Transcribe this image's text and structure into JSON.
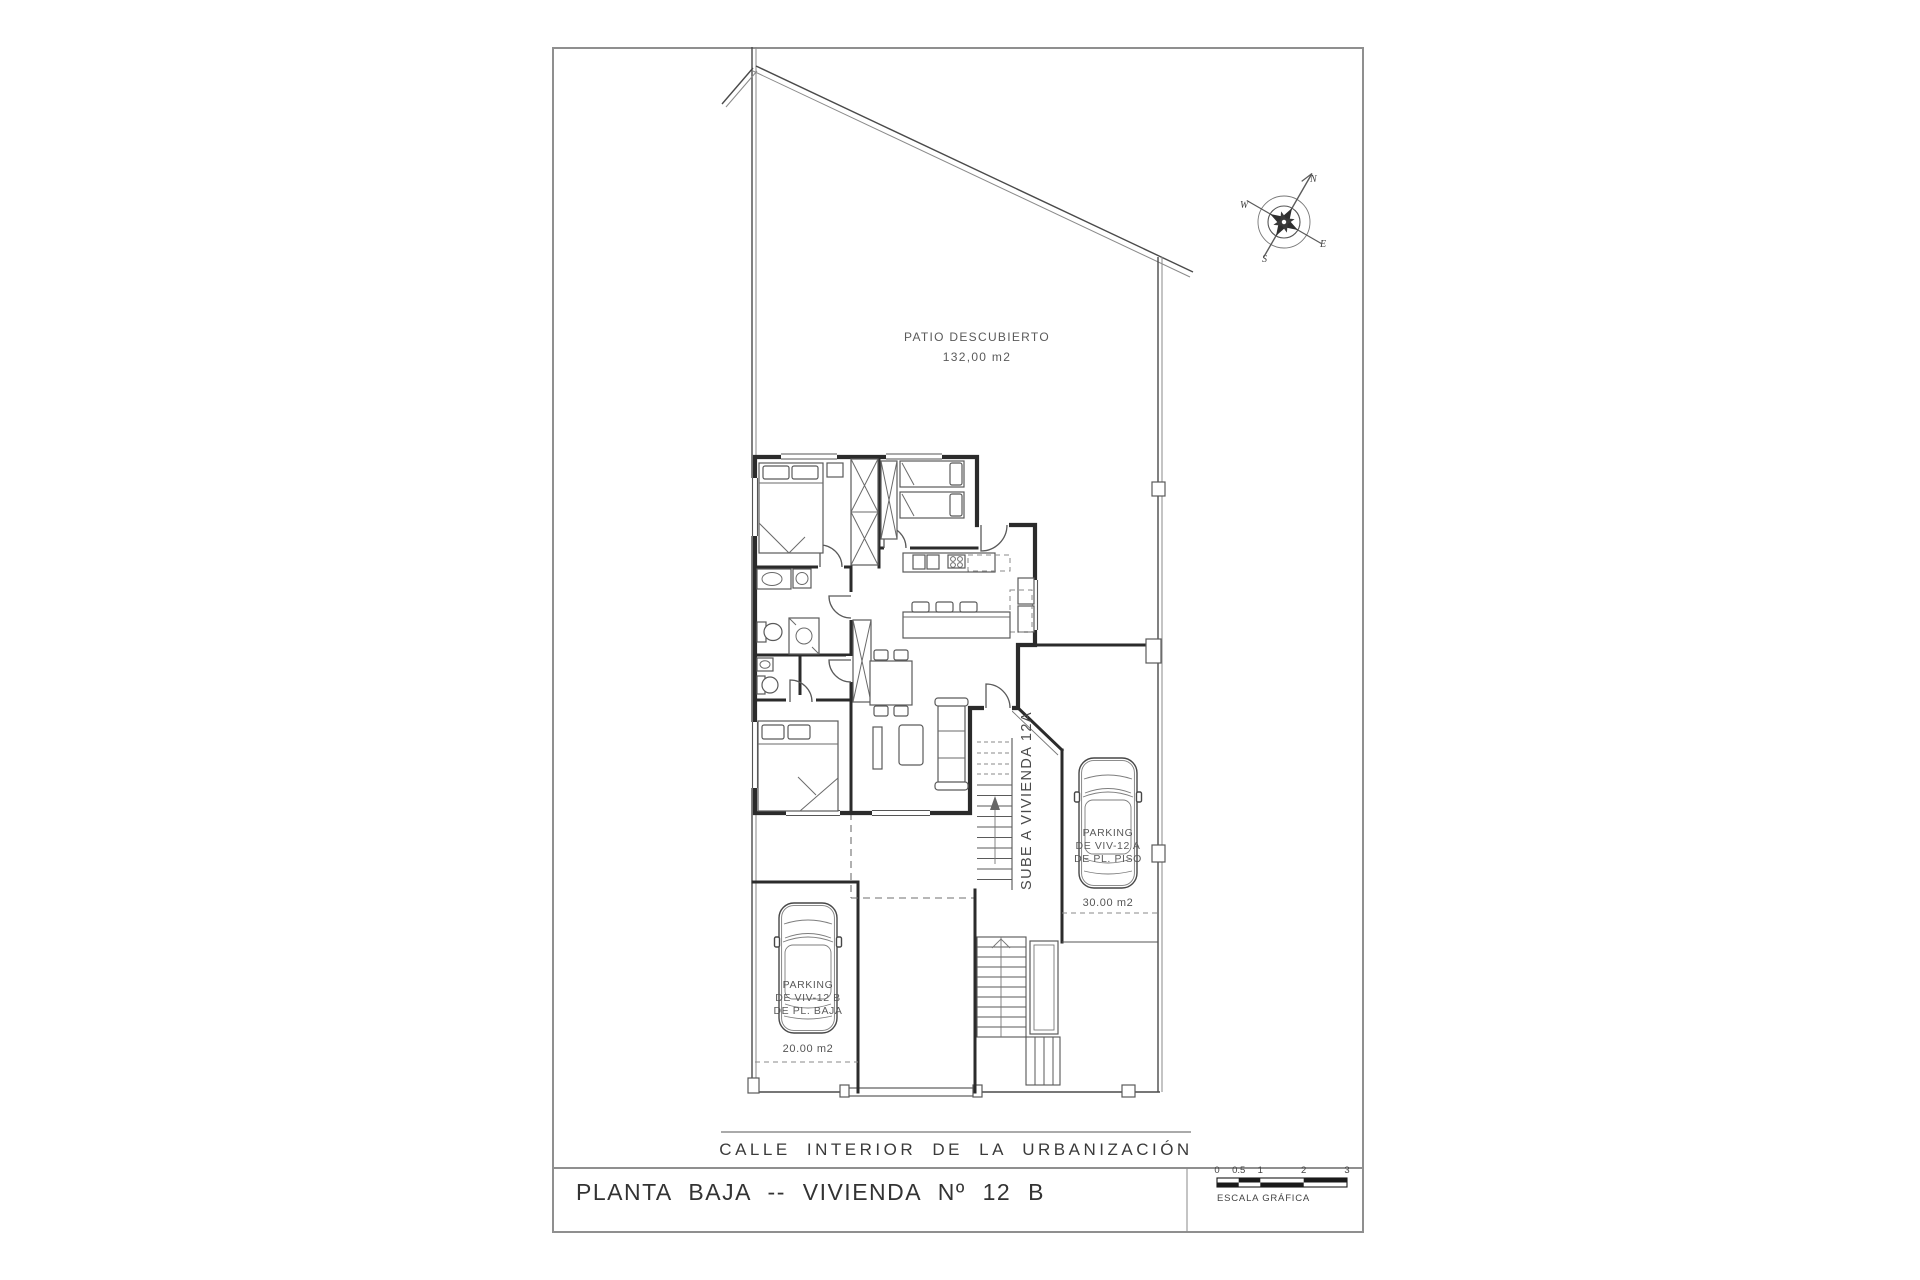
{
  "drawing": {
    "title_block": {
      "title": "PLANTA BAJA -- VIVIENDA Nº 12 B"
    },
    "street": {
      "label": "CALLE INTERIOR DE LA URBANIZACIÓN"
    },
    "patio": {
      "name": "PATIO DESCUBIERTO",
      "area": "132,00 m2"
    },
    "parking_left": {
      "line1": "PARKING",
      "line2": "DE VIV-12 B",
      "line3": "DE PL. BAJA",
      "area": "20.00 m2"
    },
    "parking_right": {
      "line1": "PARKING",
      "line2": "DE VIV-12 A",
      "line3": "DE PL. PISO",
      "area": "30.00 m2"
    },
    "stair": {
      "label": "SUBE A VIVIENDA 12A"
    },
    "compass": {
      "north": "N",
      "south": "S",
      "east": "E",
      "west": "W"
    },
    "scale_bar": {
      "ticks": [
        "0",
        "0.5",
        "1",
        "2",
        "3"
      ],
      "label": "ESCALA GRÁFICA"
    },
    "colors": {
      "wall": "#2b2b2b",
      "frame": "#8f8f8f",
      "line": "#555555"
    }
  }
}
